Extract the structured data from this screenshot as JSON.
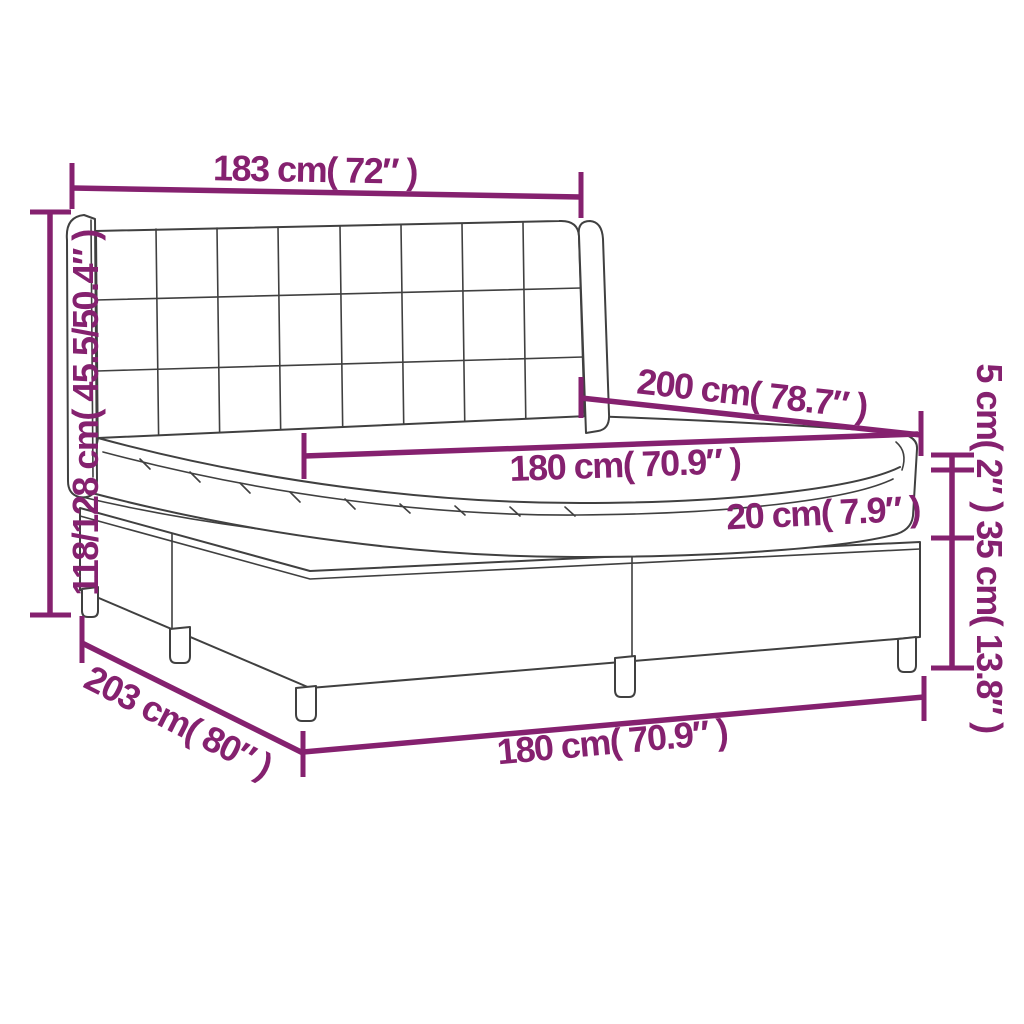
{
  "labels": {
    "headboard_width": "183 cm( 72″ )",
    "bed_height": "118/128 cm( 45.5/50.4″ )",
    "bed_length": "200 cm( 78.7″ )",
    "mattress_width": "180 cm( 70.9″ )",
    "mattress_height": "20 cm( 7.9″ )",
    "topper_and_base_height": "5 cm( 2″ ) 35 cm( 13.8″ )",
    "bed_depth": "203 cm( 80″ )",
    "base_width": "180 cm( 70.9″ )"
  },
  "colors": {
    "dimension_accent": "#85216F",
    "line_art": "#404040",
    "background": "#ffffff"
  }
}
